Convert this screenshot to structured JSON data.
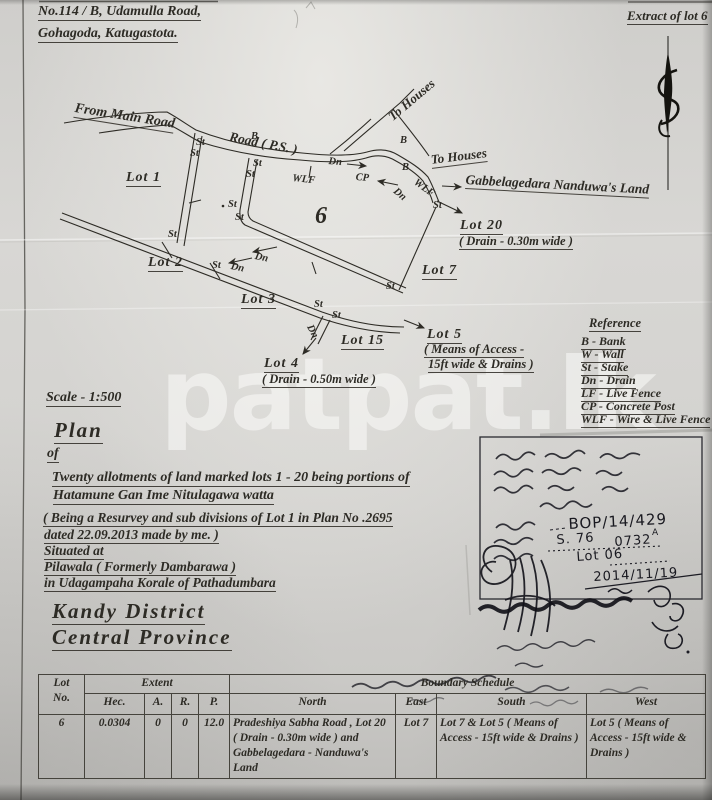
{
  "header": {
    "address_line1": "No.114 / B, Udamulla Road,",
    "address_line2": "Gohagoda, Katugastota.",
    "extract_label": "Extract of lot 6"
  },
  "diagram": {
    "labels": {
      "from_main_road": "From Main Road",
      "road_ps": "Road ( P.S. )",
      "to_houses": "To Houses",
      "gabbelagedara": "Gabbelagedara Nanduwa's Land",
      "lot1": "Lot 1",
      "lot2": "Lot  2",
      "lot3": "Lot 3",
      "lot4": "Lot  4",
      "lot4_note": "( Drain - 0.50m wide )",
      "lot5": "Lot 5",
      "lot5_note1": "( Means of Access -",
      "lot5_note2": "15ft wide & Drains )",
      "lot6": "6",
      "lot7": "Lot  7",
      "lot15": "Lot 15",
      "lot20": "Lot  20",
      "lot20_note": "( Drain - 0.30m wide )"
    },
    "marks": {
      "st": "St",
      "dn": "Dn",
      "b": "B",
      "wlf": "WLF",
      "cp": "CP"
    }
  },
  "reference": {
    "title": "Reference",
    "items": [
      "B - Bank",
      "W - Wall",
      "St - Stake",
      "Dn - Drain",
      "LF - Live Fence",
      "CP - Concrete Post",
      "WLF - Wire & Live Fence"
    ]
  },
  "scale": "Scale - 1:500",
  "plan": {
    "title": "Plan",
    "of": "of",
    "line1": "Twenty allotments of land marked  lots 1 - 20 being  portions of",
    "line2": "Hatamune Gan Ime Nitulagawa watta",
    "line3": "( Being a Resurvey and sub divisions of  Lot  1 in Plan No .2695",
    "line4": "dated 22.09.2013 made by me. )",
    "line5": "Situated at",
    "line6": "Pilawala ( Formerly Dambarawa )",
    "line7": "in Udagampaha Korale of  Pathadumbara",
    "district": "Kandy  District",
    "province": "Central  Province"
  },
  "stamp": {
    "ref_no": "BOP/14/429",
    "file_prefix": "S. 76",
    "file_no": "0732",
    "file_sup": "A",
    "lot_no": "Lot 06",
    "date": "2014/11/19"
  },
  "watermark": "patpat.lk",
  "table": {
    "headers": {
      "lot": "Lot",
      "no": "No.",
      "extent": "Extent",
      "hec": "Hec.",
      "a": "A.",
      "r": "R.",
      "p": "P.",
      "boundary": "Boundary Schedule",
      "north": "North",
      "east": "East",
      "south": "South",
      "west": "West"
    },
    "rows": [
      {
        "lot_no": "6",
        "hec": "0.0304",
        "a": "0",
        "r": "0",
        "p": "12.0",
        "north": "Pradeshiya Sabha Road , Lot 20 ( Drain - 0.30m wide ) and Gabbelagedara - Nanduwa's Land",
        "east": "Lot 7",
        "south": "Lot 7 & Lot 5 ( Means of Access - 15ft wide  & Drains )",
        "west": "Lot 5 ( Means of  Access - 15ft wide  & Drains )"
      }
    ]
  }
}
